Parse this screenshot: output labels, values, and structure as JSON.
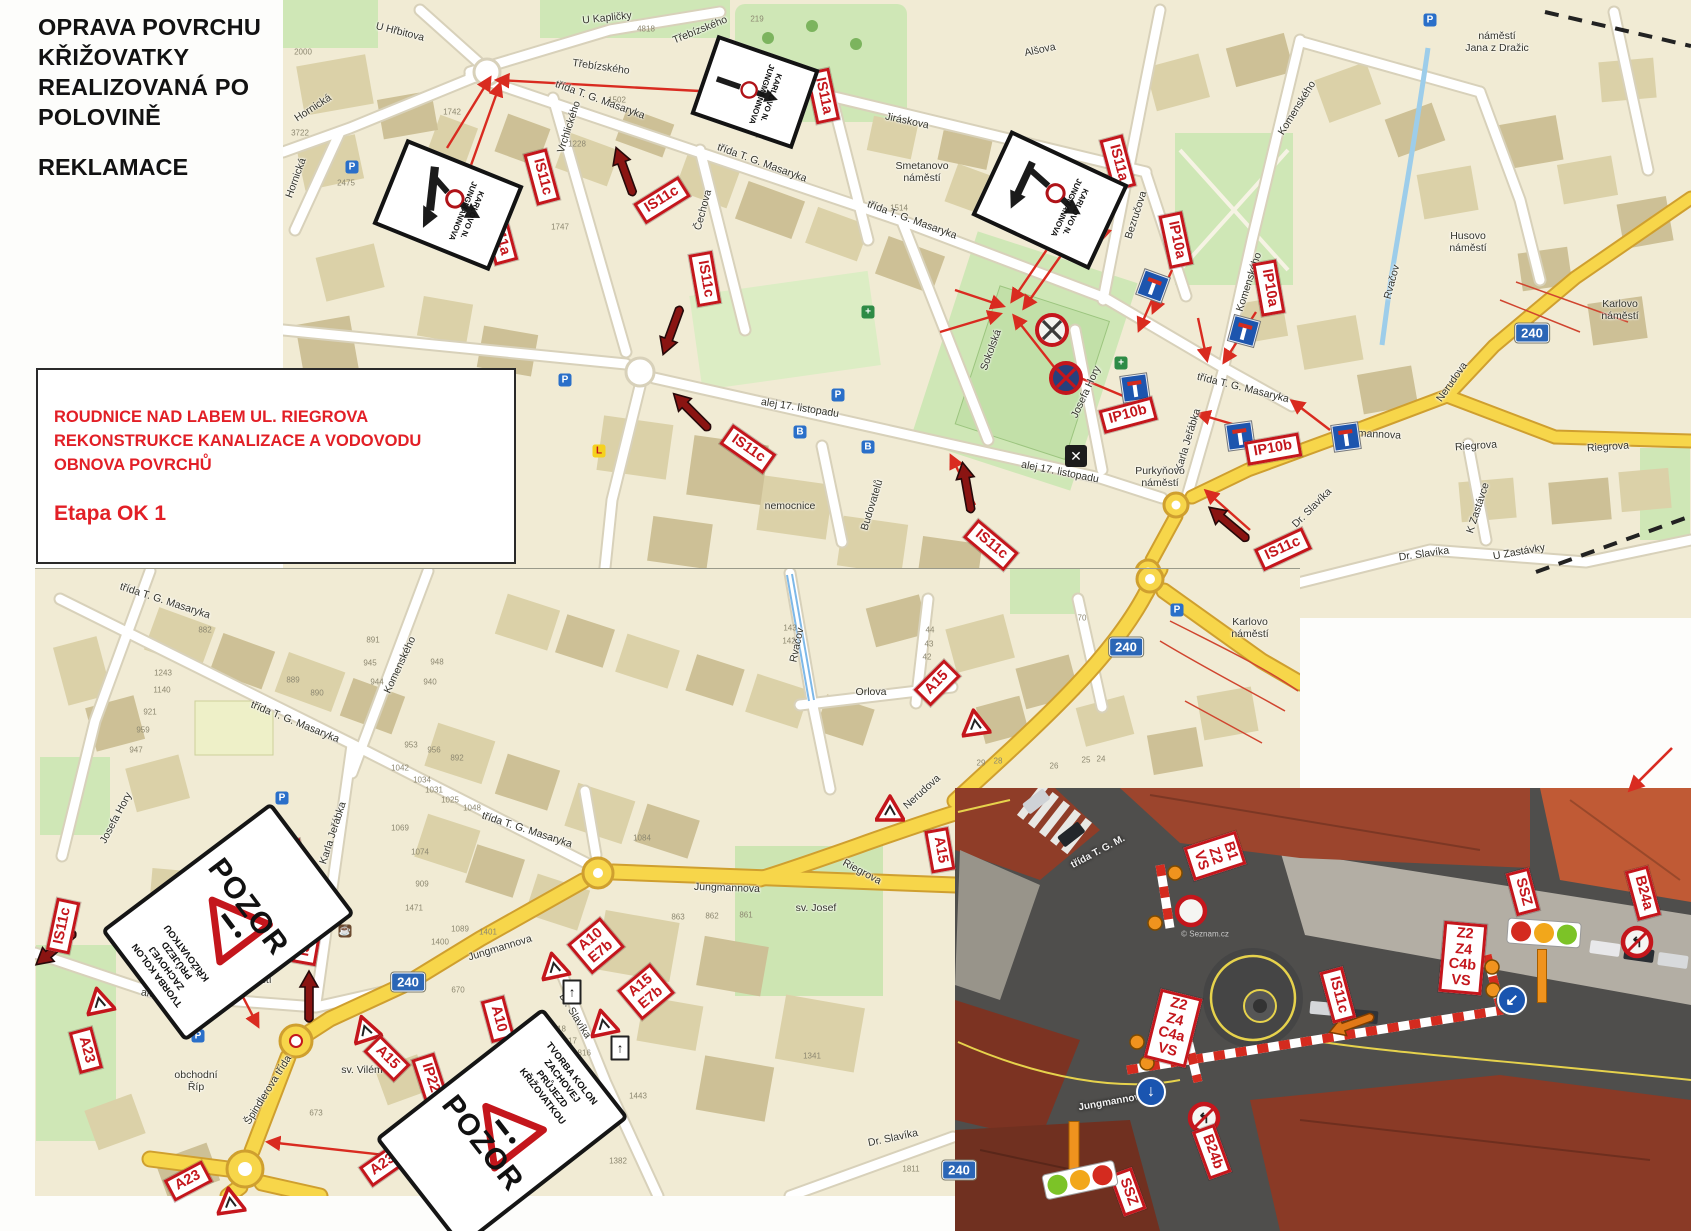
{
  "header": {
    "title": "OPRAVA POVRCHU\nKŘIŽOVATKY\nREALIZOVANÁ PO\nPOLOVINĚ",
    "subtitle": "REKLAMACE"
  },
  "info_box": {
    "text": "ROUDNICE NAD LABEM  UL. RIEGROVA\nREKONSTRUKCE KANALIZACE A VODOVODU\nOBNOVA POVRCHŮ",
    "stage": "Etapa OK 1"
  },
  "colors": {
    "sign_red": "#c4161c",
    "map_bg": "#f1ebd4",
    "yellow_road": "#f7d64a",
    "badge_blue": "#2b66b6",
    "green": "#cfe7b6",
    "marker_dark_red": "#8a1412",
    "orange": "#f0931e"
  },
  "detour_text": "KARLOVO N.\nJUNGMANNOVA",
  "detour_signs": [
    {
      "x": 448,
      "y": 205,
      "w": 118,
      "h": 84,
      "r": 22,
      "type": "fork"
    },
    {
      "x": 755,
      "y": 92,
      "w": 100,
      "h": 76,
      "r": 19,
      "type": "line"
    },
    {
      "x": 1050,
      "y": 200,
      "w": 122,
      "h": 86,
      "r": 25,
      "type": "tee"
    }
  ],
  "pozor": {
    "big": "POZOR",
    "small": "TVORBA KOLON\nZACHOVEJ\nPRŮJEZD\nKŘIŽOVATKOU",
    "signs": [
      {
        "x": 228,
        "y": 922,
        "w": 205,
        "h": 132,
        "r": -37,
        "flip": false
      },
      {
        "x": 502,
        "y": 1128,
        "w": 205,
        "h": 132,
        "r": -38,
        "flip": true
      }
    ]
  },
  "top_map": {
    "street_labels": [
      [
        "U Hřbitova",
        400,
        32,
        14
      ],
      [
        "U Kapličky",
        607,
        18,
        -6
      ],
      [
        "Třebízského",
        700,
        30,
        -22
      ],
      [
        "Třebízského",
        601,
        67,
        8
      ],
      [
        "Hornická",
        313,
        108,
        -33
      ],
      [
        "Hornická",
        296,
        178,
        -70
      ],
      [
        "Vrchlického",
        569,
        127,
        -72
      ],
      [
        "třída T. G. Masaryka",
        600,
        100,
        20
      ],
      [
        "třída T. G. Masaryka",
        762,
        163,
        20
      ],
      [
        "třída T. G. Masaryka",
        912,
        220,
        20
      ],
      [
        "třída T. G. Masaryka",
        1243,
        388,
        14
      ],
      [
        "Čechova",
        703,
        210,
        -75
      ],
      [
        "Jiráskova",
        907,
        121,
        12
      ],
      [
        "Smetanovo\nnáměstí",
        922,
        172,
        0
      ],
      [
        "Alšova",
        1040,
        50,
        -12
      ],
      [
        "Bezručova",
        1136,
        215,
        -72
      ],
      [
        "Komenského",
        1297,
        108,
        -58
      ],
      [
        "Komenského",
        1249,
        282,
        -72
      ],
      [
        "náměstí\nJana z Dražic",
        1497,
        42,
        0
      ],
      [
        "Husovo\nnáměstí",
        1468,
        242,
        0
      ],
      [
        "Sokolská",
        991,
        350,
        -70
      ],
      [
        "Josefa Hory",
        1086,
        392,
        -65
      ],
      [
        "Karla Jeřábka",
        1188,
        440,
        -73
      ],
      [
        "Purkyňovo\nnáměstí",
        1160,
        477,
        0
      ],
      [
        "alej 17. listopadu",
        800,
        408,
        9
      ],
      [
        "alej 17. listopadu",
        1060,
        472,
        11
      ],
      [
        "nemocnice",
        790,
        506,
        0
      ],
      [
        "Budovatelů",
        872,
        505,
        -73
      ],
      [
        "Jungmannova",
        1368,
        434,
        3
      ],
      [
        "Riegrova",
        1476,
        446,
        -4
      ],
      [
        "Riegrova",
        1608,
        447,
        -4
      ],
      [
        "Nerudova",
        1452,
        382,
        -55
      ],
      [
        "Dr. Slavíka",
        1424,
        554,
        -8
      ],
      [
        "Dr. Slavíka",
        1312,
        508,
        -45
      ],
      [
        "K Zastávce",
        1478,
        508,
        -72
      ],
      [
        "U Zastávky",
        1519,
        552,
        -10
      ],
      [
        "Karlovo\nnáměstí",
        1620,
        310,
        0
      ],
      [
        "Rvačov",
        1392,
        282,
        -75
      ]
    ],
    "house_numbers": [
      [
        "2000",
        303,
        52
      ],
      [
        "3722",
        300,
        133
      ],
      [
        "2475",
        346,
        183
      ],
      [
        "1742",
        452,
        112
      ],
      [
        "1747",
        560,
        227
      ],
      [
        "1228",
        577,
        144
      ],
      [
        "4818",
        646,
        29
      ],
      [
        "1502",
        617,
        100
      ],
      [
        "219",
        757,
        19
      ],
      [
        "1518",
        764,
        135
      ],
      [
        "1514",
        899,
        208
      ]
    ],
    "sign_labels": [
      [
        "IS11c",
        542,
        177,
        75
      ],
      [
        "IS11a",
        500,
        237,
        75
      ],
      [
        "IS11c",
        662,
        200,
        -32
      ],
      [
        "IS11a",
        823,
        96,
        78
      ],
      [
        "IS11c",
        705,
        279,
        80
      ],
      [
        "IS11c",
        748,
        449,
        35
      ],
      [
        "IS11c",
        991,
        545,
        40
      ],
      [
        "IS11a",
        1118,
        163,
        75
      ],
      [
        "IP10a",
        1176,
        240,
        78
      ],
      [
        "IP10a",
        1269,
        288,
        80
      ],
      [
        "IP10b",
        1128,
        415,
        -15
      ],
      [
        "IP10b",
        1273,
        449,
        -10
      ],
      [
        "IS11c",
        1283,
        549,
        -25
      ]
    ],
    "badges": [
      [
        "240",
        1532,
        333
      ]
    ],
    "arrows": [
      [
        447,
        148,
        490,
        78
      ],
      [
        470,
        168,
        500,
        84
      ],
      [
        718,
        92,
        497,
        80
      ],
      [
        1052,
        242,
        1012,
        301
      ],
      [
        1062,
        254,
        1024,
        308
      ],
      [
        955,
        290,
        1003,
        306
      ],
      [
        940,
        332,
        1000,
        314
      ],
      [
        1058,
        372,
        1014,
        316
      ],
      [
        1152,
        300,
        1139,
        330
      ],
      [
        1198,
        318,
        1207,
        360
      ],
      [
        1256,
        312,
        1224,
        362
      ],
      [
        1128,
        398,
        1066,
        372
      ],
      [
        1253,
        430,
        1198,
        414
      ],
      [
        1330,
        430,
        1292,
        401
      ],
      [
        975,
        505,
        951,
        456
      ],
      [
        1250,
        530,
        1206,
        491
      ],
      [
        1115,
        192,
        1101,
        240
      ],
      [
        1172,
        270,
        1153,
        312
      ]
    ],
    "marker_arrows": [
      [
        625,
        172,
        -20
      ],
      [
        672,
        330,
        200
      ],
      [
        692,
        412,
        -45
      ],
      [
        967,
        488,
        -10
      ],
      [
        1229,
        524,
        -50
      ]
    ],
    "deadend_signs": [
      [
        1153,
        286,
        20
      ],
      [
        1244,
        331,
        15
      ],
      [
        1135,
        388,
        -8
      ],
      [
        1240,
        436,
        -8
      ],
      [
        1346,
        437,
        -8
      ]
    ],
    "round_signs": [
      [
        1052,
        330,
        "nostop"
      ],
      [
        1066,
        378,
        "nostop2"
      ]
    ],
    "mill_icons": [
      [
        1076,
        456
      ]
    ],
    "poi": [
      [
        "P",
        352,
        167,
        "p"
      ],
      [
        "P",
        565,
        380,
        "p"
      ],
      [
        "P",
        838,
        395,
        "p"
      ],
      [
        "P",
        1430,
        20,
        "p"
      ],
      [
        "+",
        868,
        312,
        "g"
      ],
      [
        "+",
        1121,
        363,
        "g"
      ],
      [
        "B",
        800,
        432,
        "b"
      ],
      [
        "B",
        868,
        447,
        "b"
      ],
      [
        "L",
        599,
        451,
        "l"
      ]
    ]
  },
  "bottom_map": {
    "street_labels": [
      [
        "třída T. G. Masaryka",
        165,
        601,
        18
      ],
      [
        "třída T. G. Masaryka",
        295,
        722,
        22
      ],
      [
        "třída T. G. Masaryka",
        527,
        830,
        18
      ],
      [
        "Komenského",
        400,
        665,
        -65
      ],
      [
        "Josefa Hory",
        116,
        818,
        -62
      ],
      [
        "Karla Jeřábka",
        333,
        833,
        -72
      ],
      [
        "alej 17. listopadu",
        180,
        999,
        10
      ],
      [
        "Purkyňovo\nnáměstí",
        253,
        974,
        0
      ],
      [
        "Špindlerova třída",
        268,
        1090,
        -58
      ],
      [
        "obchodní\nŘíp",
        196,
        1081,
        0
      ],
      [
        "sv. Vilém",
        362,
        1070,
        0
      ],
      [
        "Jungmannova",
        727,
        888,
        2
      ],
      [
        "Jungmannova",
        500,
        948,
        -17
      ],
      [
        "Riegrova",
        862,
        872,
        28
      ],
      [
        "Nerudova",
        922,
        792,
        -42
      ],
      [
        "Orlova",
        871,
        692,
        0
      ],
      [
        "Dr. Slavíka",
        575,
        1016,
        58
      ],
      [
        "Dr. Slavíka",
        893,
        1138,
        -12
      ],
      [
        "Karlovo\nnáměstí",
        1250,
        628,
        0
      ],
      [
        "Rvačov",
        797,
        645,
        -78
      ],
      [
        "sv. Josef",
        816,
        908,
        0
      ]
    ],
    "house_numbers": [
      [
        "882",
        205,
        630
      ],
      [
        "891",
        373,
        640
      ],
      [
        "945",
        370,
        663
      ],
      [
        "944",
        377,
        682
      ],
      [
        "948",
        437,
        662
      ],
      [
        "940",
        430,
        682
      ],
      [
        "889",
        293,
        680
      ],
      [
        "890",
        317,
        693
      ],
      [
        "953",
        411,
        745
      ],
      [
        "956",
        434,
        750
      ],
      [
        "892",
        457,
        758
      ],
      [
        "1243",
        163,
        673
      ],
      [
        "1140",
        162,
        690
      ],
      [
        "921",
        150,
        712
      ],
      [
        "959",
        143,
        730
      ],
      [
        "947",
        136,
        750
      ],
      [
        "1042",
        400,
        768
      ],
      [
        "1034",
        422,
        780
      ],
      [
        "1031",
        434,
        790
      ],
      [
        "1025",
        450,
        800
      ],
      [
        "1048",
        472,
        808
      ],
      [
        "1069",
        400,
        828
      ],
      [
        "1074",
        420,
        852
      ],
      [
        "909",
        422,
        884
      ],
      [
        "1471",
        414,
        908
      ],
      [
        "1400",
        440,
        942
      ],
      [
        "1089",
        460,
        929
      ],
      [
        "1401",
        488,
        932
      ],
      [
        "670",
        458,
        990
      ],
      [
        "673",
        316,
        1113
      ],
      [
        "1818",
        557,
        1029
      ],
      [
        "1817",
        568,
        1041
      ],
      [
        "1816",
        582,
        1053
      ],
      [
        "1814",
        574,
        1078
      ],
      [
        "1813",
        602,
        1096
      ],
      [
        "1443",
        638,
        1096
      ],
      [
        "1382",
        618,
        1161
      ],
      [
        "1341",
        812,
        1056
      ],
      [
        "1084",
        642,
        838
      ],
      [
        "863",
        678,
        917
      ],
      [
        "862",
        712,
        916
      ],
      [
        "861",
        746,
        915
      ],
      [
        "44",
        930,
        630
      ],
      [
        "43",
        929,
        644
      ],
      [
        "42",
        927,
        657
      ],
      [
        "70",
        1082,
        618
      ],
      [
        "143",
        790,
        628
      ],
      [
        "142",
        789,
        641
      ],
      [
        "29",
        981,
        763
      ],
      [
        "28",
        998,
        761
      ],
      [
        "26",
        1054,
        766
      ],
      [
        "25",
        1086,
        760
      ],
      [
        "24",
        1101,
        759
      ],
      [
        "1811",
        911,
        1169
      ]
    ],
    "sign_labels": [
      [
        "IS11c",
        63,
        926,
        -78
      ],
      [
        "IP22",
        293,
        863,
        78
      ],
      [
        "IS11c",
        308,
        938,
        -80
      ],
      [
        "A23",
        86,
        1050,
        75
      ],
      [
        "A23",
        188,
        1181,
        -28
      ],
      [
        "A23",
        383,
        1165,
        -35
      ],
      [
        "A15",
        387,
        1058,
        45
      ],
      [
        "IP22",
        430,
        1078,
        72
      ],
      [
        "A10",
        498,
        1019,
        75
      ],
      [
        "A10\nE7b",
        596,
        946,
        -40
      ],
      [
        "A15\nE7b",
        646,
        992,
        -40
      ],
      [
        "A15",
        937,
        683,
        -45
      ],
      [
        "A15",
        940,
        850,
        80
      ]
    ],
    "badges": [
      [
        "240",
        1126,
        647
      ],
      [
        "240",
        408,
        982
      ],
      [
        "240",
        959,
        1170
      ]
    ],
    "arrows": [
      [
        228,
        968,
        258,
        1026
      ],
      [
        430,
        1160,
        268,
        1142
      ]
    ],
    "marker_arrows": [
      [
        56,
        948,
        230
      ],
      [
        309,
        997,
        0
      ]
    ],
    "triangles": [
      [
        554,
        965,
        -12
      ],
      [
        603,
        1022,
        -12
      ],
      [
        365,
        1028,
        -18
      ],
      [
        99,
        1000,
        -12
      ],
      [
        230,
        1200,
        -8
      ],
      [
        975,
        722,
        -8
      ],
      [
        890,
        808,
        0
      ]
    ],
    "panels": [
      [
        572,
        992
      ],
      [
        620,
        1048
      ]
    ],
    "poi": [
      [
        "P",
        198,
        1036,
        "p"
      ],
      [
        "P",
        282,
        798,
        "p"
      ],
      [
        "P",
        1177,
        610,
        "p"
      ],
      [
        "☕",
        238,
        867,
        "c"
      ],
      [
        "☕",
        345,
        931,
        "c"
      ]
    ]
  },
  "aerial": {
    "labels": [
      [
        "B1\nZ2\nVS",
        1215,
        856,
        72
      ],
      [
        "Z2\nZ4\nC4a\nVS",
        1173,
        1028,
        14
      ],
      [
        "Z2\nZ4\nC4b\nVS",
        1463,
        958,
        5
      ],
      [
        "SSZ",
        1523,
        892,
        75
      ],
      [
        "SSZ",
        1128,
        1192,
        70
      ],
      [
        "B24a",
        1643,
        893,
        75
      ],
      [
        "B24b",
        1212,
        1152,
        70
      ],
      [
        "IS11c",
        1338,
        995,
        75
      ]
    ],
    "street_texts": [
      [
        "třída T. G. M.",
        1098,
        852,
        -28
      ],
      [
        "Jungmannova",
        1112,
        1102,
        -10
      ]
    ],
    "watermark": "© Seznam.cz",
    "watermark_pos": [
      1205,
      934
    ],
    "traffic_lights": [
      {
        "x": 1544,
        "y": 933,
        "r": 4,
        "colors": [
          "#d42b1f",
          "#f2a71b",
          "#7cc327"
        ]
      },
      {
        "x": 1080,
        "y": 1180,
        "r": -12,
        "colors": [
          "#7cc327",
          "#f2a71b",
          "#d42b1f"
        ]
      }
    ],
    "orange_bars": [
      [
        1542,
        950,
        8,
        52
      ],
      [
        1074,
        1122,
        9,
        50
      ]
    ],
    "orange_dots": [
      [
        1175,
        873
      ],
      [
        1155,
        923
      ],
      [
        1137,
        1042
      ],
      [
        1147,
        1063
      ],
      [
        1492,
        967
      ],
      [
        1493,
        990
      ]
    ],
    "barriers": [
      [
        1127,
        1070,
        1503,
        1010
      ],
      [
        1160,
        865,
        1170,
        928
      ],
      [
        1487,
        955,
        1500,
        1005
      ],
      [
        1186,
        1032,
        1198,
        1082
      ]
    ],
    "round_signs": [
      [
        1191,
        911,
        "b1"
      ],
      [
        1637,
        942,
        "turn"
      ],
      [
        1204,
        1118,
        "turn"
      ]
    ],
    "blue_signs": [
      [
        1512,
        1000,
        "↙"
      ],
      [
        1151,
        1092,
        "↓"
      ]
    ],
    "orange_marker": [
      1352,
      1024,
      250
    ],
    "page_arrow": [
      1672,
      748,
      1630,
      790
    ]
  }
}
